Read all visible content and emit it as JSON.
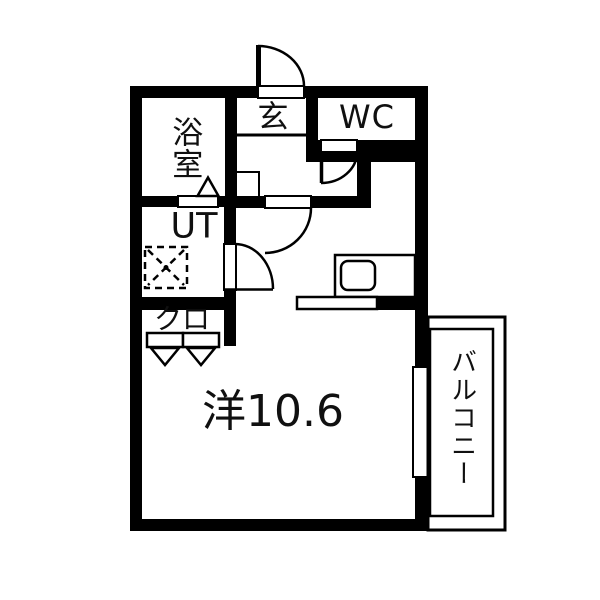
{
  "floorplan": {
    "background": "#ffffff",
    "wall_color": "#000000",
    "rooms": {
      "bathroom": {
        "label": "浴室"
      },
      "entrance": {
        "label": "玄"
      },
      "toilet": {
        "label": "WC"
      },
      "utility": {
        "label": "UT"
      },
      "closet": {
        "label": "クロ"
      },
      "living_room": {
        "label": "洋10.6"
      },
      "balcony": {
        "label": "バルコニー"
      }
    },
    "fixtures": [
      "entrance-door-swing",
      "toilet-door-swing",
      "living-room-door-swing",
      "utility-door-swing",
      "bathroom-door-triangle",
      "closet-sliding-doors",
      "washing-machine-space",
      "kitchen-counter",
      "kitchen-sink",
      "balcony-window"
    ]
  }
}
